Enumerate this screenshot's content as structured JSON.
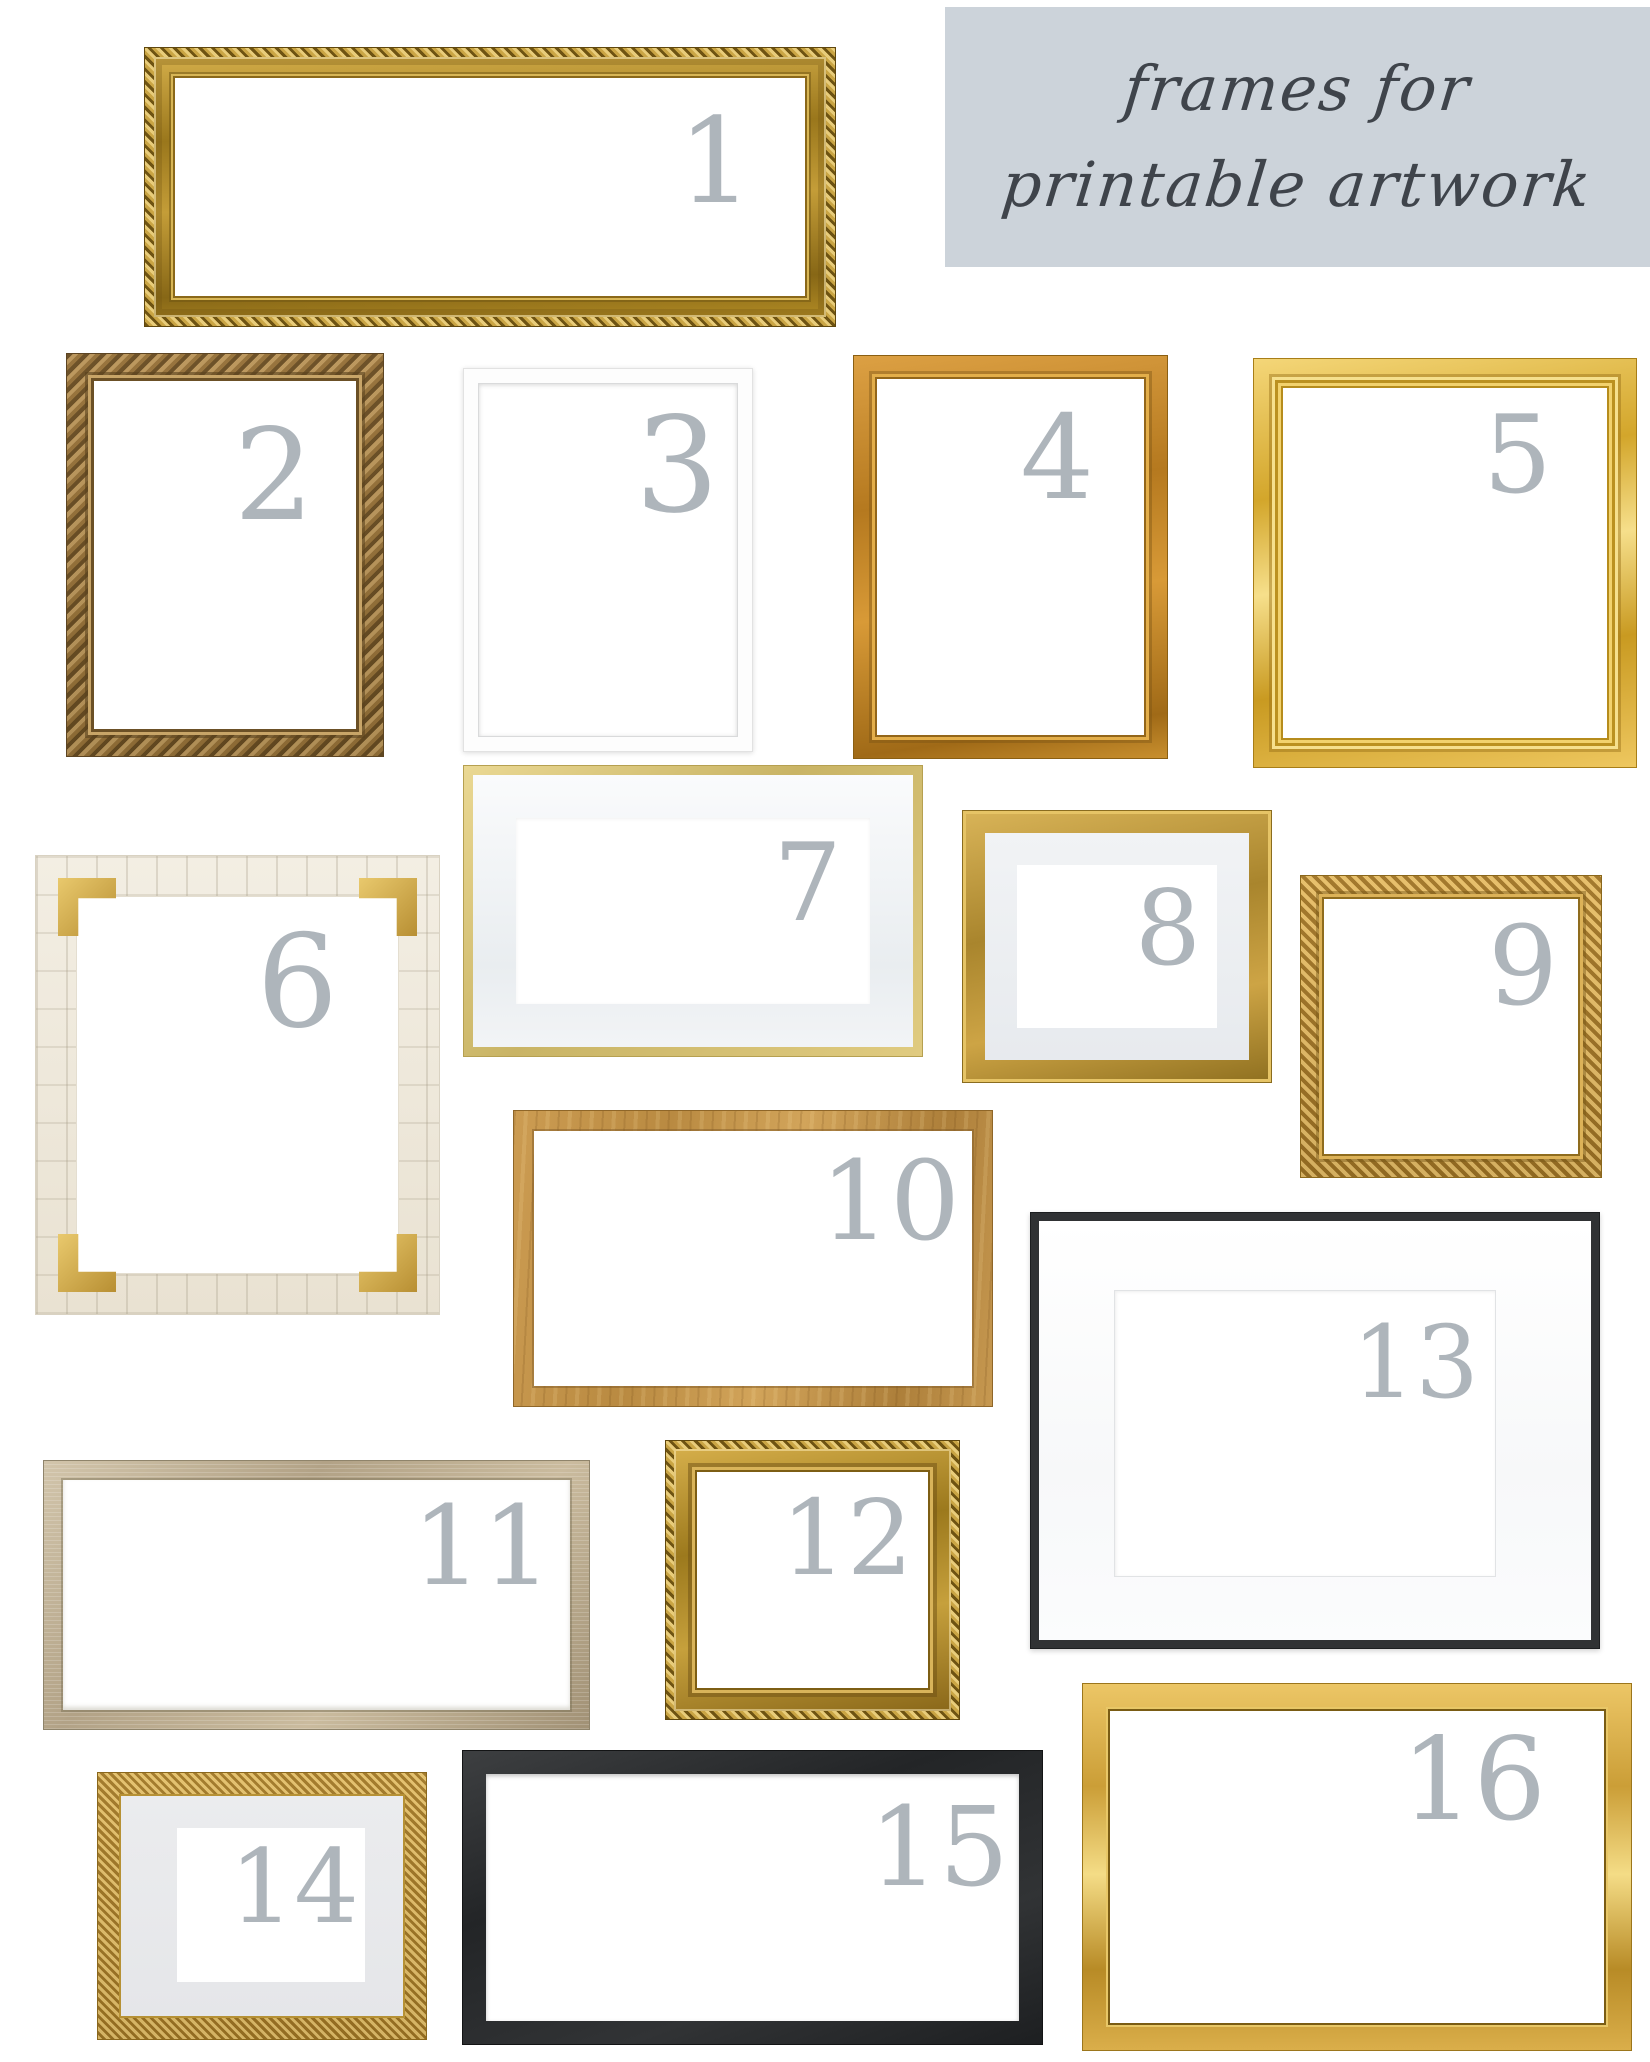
{
  "page": {
    "width": 1650,
    "height": 2062,
    "background": "#ffffff"
  },
  "title": {
    "line1": "frames for",
    "line2": "printable artwork",
    "background": "#ccd3da",
    "text_color": "#3f444b"
  },
  "numbers": {
    "color": "#aeb5bb"
  },
  "frames": [
    {
      "number": "1",
      "style": "ornate gold rope, wide landscape"
    },
    {
      "number": "2",
      "style": "antique ornate bronze-gold, portrait"
    },
    {
      "number": "3",
      "style": "simple white, portrait"
    },
    {
      "number": "4",
      "style": "classic warm gold, portrait"
    },
    {
      "number": "5",
      "style": "bright yellow gold stepped, portrait"
    },
    {
      "number": "6",
      "style": "ivory bone tile with brass corners, portrait"
    },
    {
      "number": "7",
      "style": "thin pale gold with light mat, landscape"
    },
    {
      "number": "8",
      "style": "gold with light gray mat, landscape"
    },
    {
      "number": "9",
      "style": "carved gold, square"
    },
    {
      "number": "10",
      "style": "oak wood-gold, landscape"
    },
    {
      "number": "11",
      "style": "champagne wood, wide landscape"
    },
    {
      "number": "12",
      "style": "gold rope, square"
    },
    {
      "number": "13",
      "style": "thin black with wide white mat, landscape"
    },
    {
      "number": "14",
      "style": "ornate gold with gray mat, landscape"
    },
    {
      "number": "15",
      "style": "matte black, wide landscape"
    },
    {
      "number": "16",
      "style": "polished gold with beaded inner edge, landscape"
    }
  ]
}
